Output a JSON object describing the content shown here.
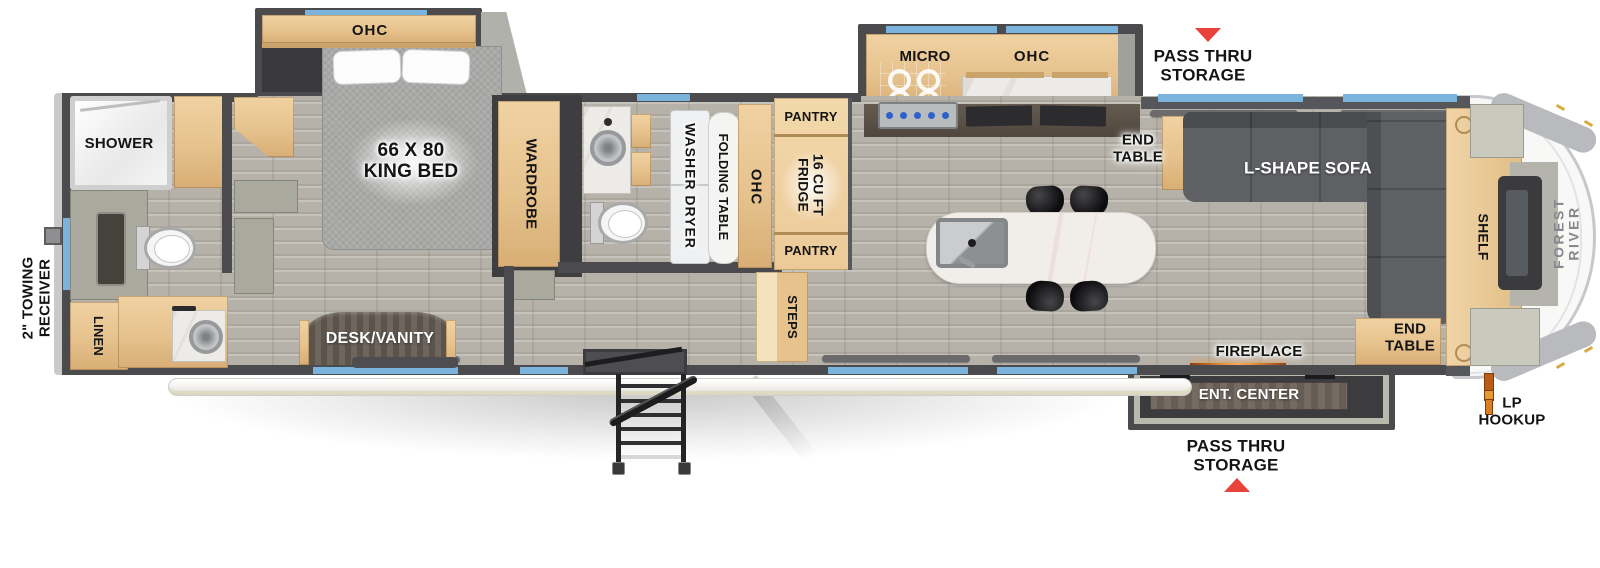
{
  "title": "Fifth wheel travel trailer floor plan",
  "colors": {
    "wall": "#4b4b4d",
    "window_blue": "#7ab3dc",
    "cabinet_wood": "#e9c897",
    "floor_gray": "#b6b2a9",
    "arrow_red": "#e8433a",
    "sofa_gray": "#5e6064",
    "lp_orange": "#e08a28"
  },
  "exterior": {
    "towing_receiver": "2\" TOWING\nRECEIVER",
    "pass_thru_storage_top": "PASS THRU\nSTORAGE",
    "pass_thru_storage_bottom": "PASS THRU\nSTORAGE",
    "lp_hookup": "LP\nHOOKUP",
    "brand_front_cap": "FOREST RIVER"
  },
  "rear_bath": {
    "shower": "SHOWER",
    "linen": "LINEN"
  },
  "bedroom": {
    "ohc": "OHC",
    "king_bed": "66 X 80\nKING BED",
    "wardrobe": "WARDROBE",
    "desk_vanity": "DESK/VANITY"
  },
  "laundry_hall": {
    "washer_dryer": "WASHER DRYER",
    "folding_table": "FOLDING TABLE",
    "ohc": "OHC",
    "pantry_top": "PANTRY",
    "fridge": "16 CU FT\nFRIDGE",
    "pantry_bottom": "PANTRY",
    "steps": "STEPS"
  },
  "kitchen": {
    "micro": "MICRO",
    "ohc": "OHC"
  },
  "living": {
    "end_table_top": "END\nTABLE",
    "l_shape_sofa": "L-SHAPE SOFA",
    "shelf": "SHELF",
    "end_table_bottom": "END\nTABLE",
    "fireplace": "FIREPLACE",
    "ent_center": "ENT. CENTER"
  }
}
